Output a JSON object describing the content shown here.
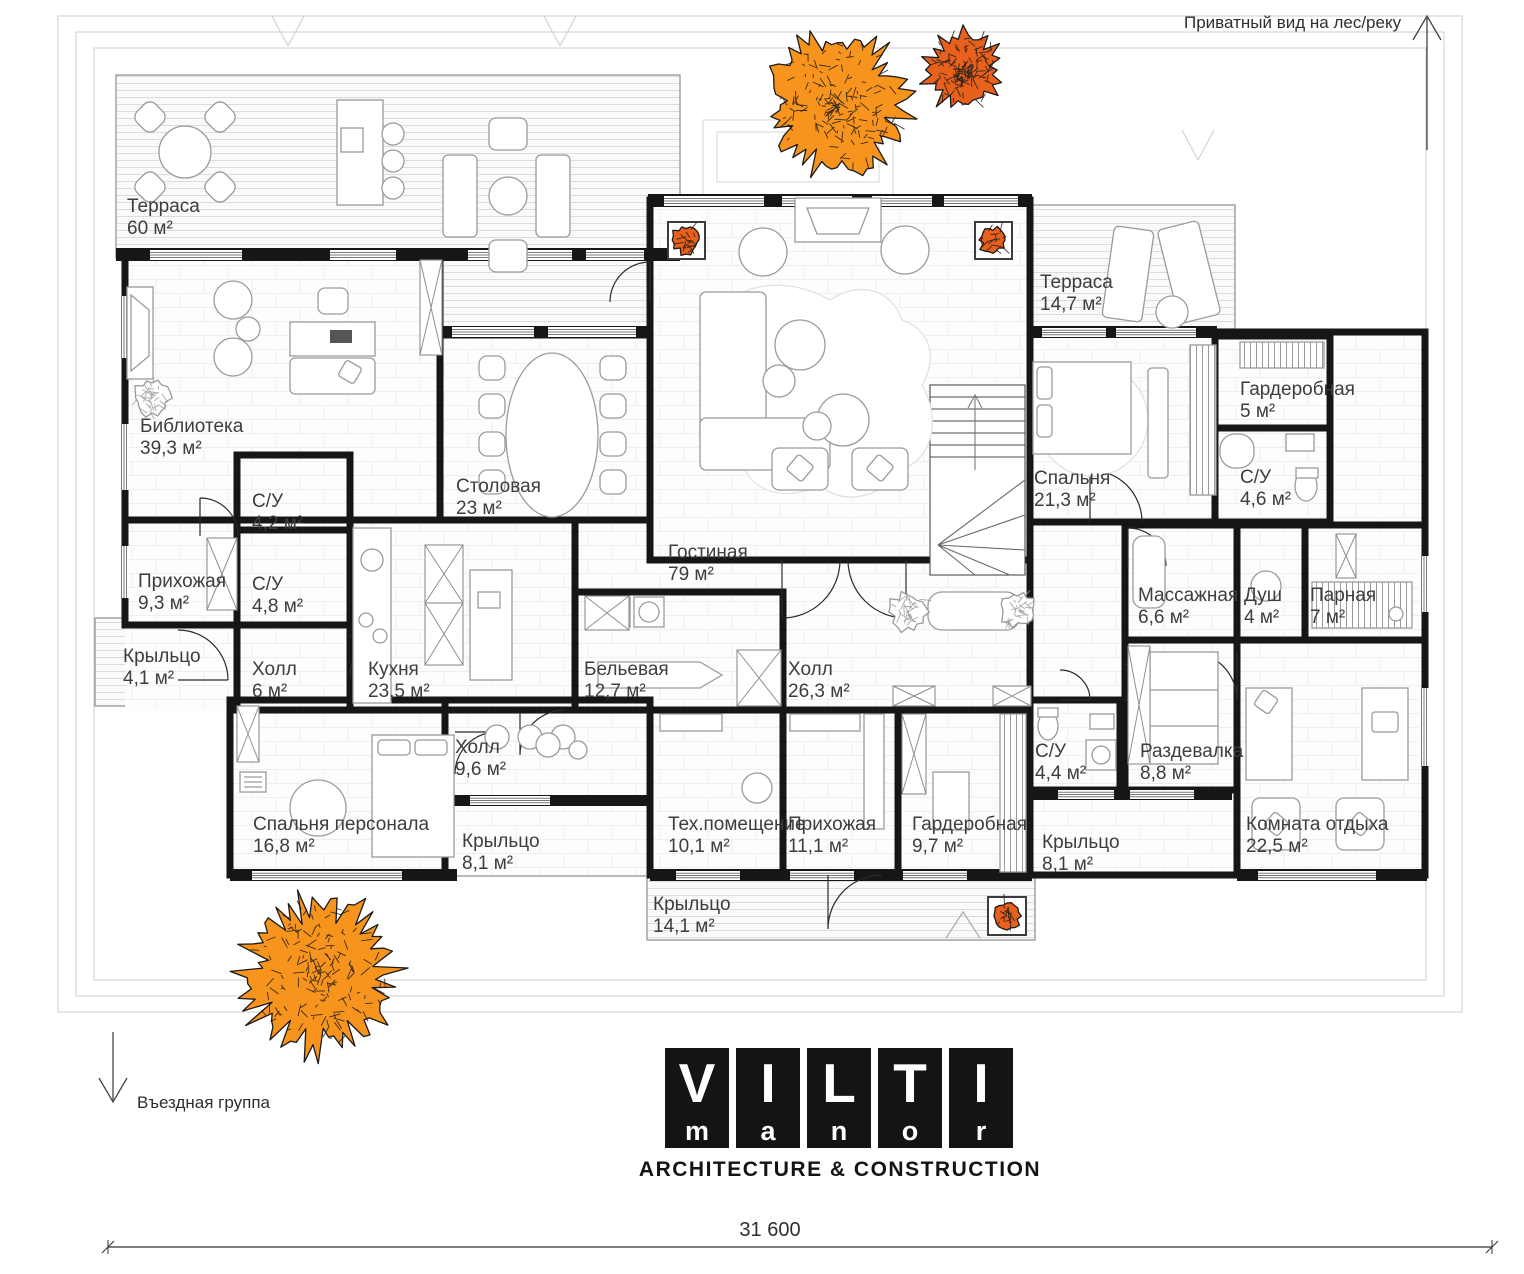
{
  "annotations": {
    "private_view": "Приватный вид на лес/реку",
    "entrance_group": "Въездная группа",
    "total_width_dimension": "31 600"
  },
  "logo": {
    "letters_top": [
      "V",
      "I",
      "L",
      "T",
      "I"
    ],
    "letters_bottom": [
      "m",
      "a",
      "n",
      "o",
      "r"
    ],
    "tagline": "ARCHITECTURE & CONSTRUCTION"
  },
  "colors": {
    "tree_orange": "#F7941D",
    "tree_dark_orange": "#E8611C",
    "wall_black": "#161616"
  },
  "rooms": [
    {
      "name": "Терраса",
      "area": "60 м²"
    },
    {
      "name": "Библиотека",
      "area": "39,3 м²"
    },
    {
      "name": "Прихожая",
      "area": "9,3 м²"
    },
    {
      "name": "Крыльцо",
      "area": "4,1 м²"
    },
    {
      "name": "С/У",
      "area": "4,2 м²"
    },
    {
      "name": "С/У",
      "area": "4,8 м²"
    },
    {
      "name": "Холл",
      "area": "6 м²"
    },
    {
      "name": "Кухня",
      "area": "23,5 м²"
    },
    {
      "name": "Столовая",
      "area": "23 м²"
    },
    {
      "name": "Гостиная",
      "area": "79 м²"
    },
    {
      "name": "Бельевая",
      "area": "12,7 м²"
    },
    {
      "name": "Холл",
      "area": "26,3 м²"
    },
    {
      "name": "Терраса",
      "area": "14,7 м²"
    },
    {
      "name": "Спальня",
      "area": "21,3 м²"
    },
    {
      "name": "Гардеробная",
      "area": "5 м²"
    },
    {
      "name": "С/У",
      "area": "4,6 м²"
    },
    {
      "name": "Массажная",
      "area": "6,6 м²"
    },
    {
      "name": "Душ",
      "area": "4 м²"
    },
    {
      "name": "Парная",
      "area": "7 м²"
    },
    {
      "name": "Раздевалка",
      "area": "8,8 м²"
    },
    {
      "name": "Комната отдыха",
      "area": "22,5 м²"
    },
    {
      "name": "С/У",
      "area": "4,4 м²"
    },
    {
      "name": "Крыльцо",
      "area": "8,1 м²"
    },
    {
      "name": "Гардеробная",
      "area": "9,7 м²"
    },
    {
      "name": "Прихожая",
      "area": "11,1 м²"
    },
    {
      "name": "Тех.помещение",
      "area": "10,1 м²"
    },
    {
      "name": "Крыльцо",
      "area": "8,1 м²"
    },
    {
      "name": "Холл",
      "area": "9,6 м²"
    },
    {
      "name": "Спальня персонала",
      "area": "16,8 м²"
    },
    {
      "name": "Крыльцо",
      "area": "14,1 м²"
    }
  ]
}
